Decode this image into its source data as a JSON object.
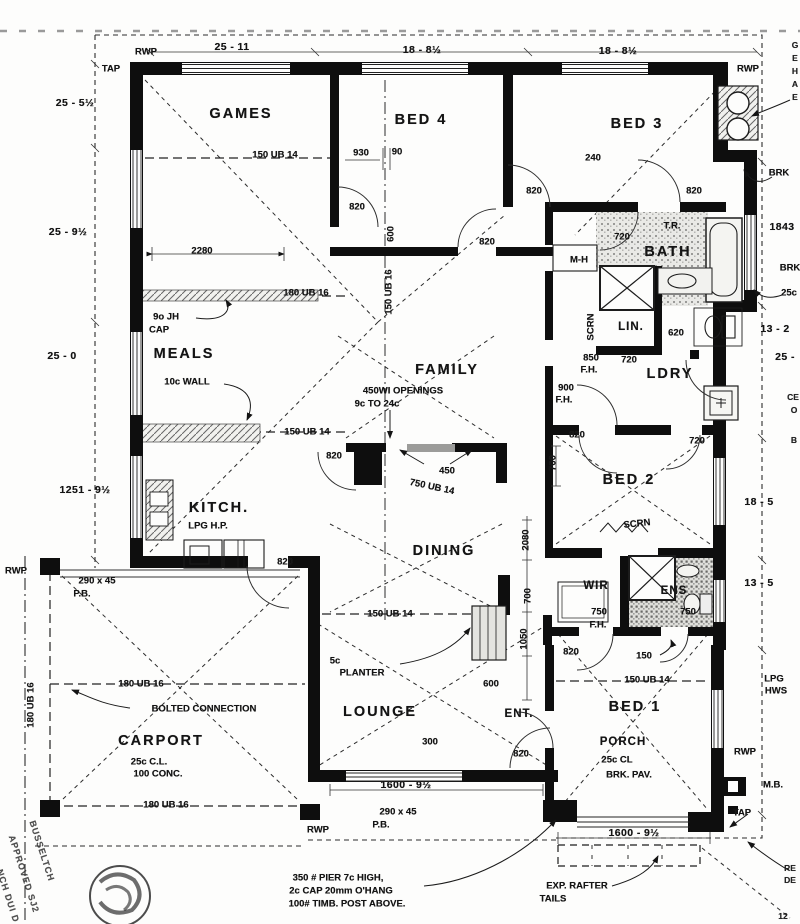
{
  "document": {
    "kind": "scanned residential floor plan working drawing"
  },
  "colors": {
    "ink": "#141414",
    "paper": "#fdfdfc",
    "tile_gray": "#9a9a98",
    "opening_gray": "#9c9c9a"
  },
  "labels": [
    {
      "t": "RWP",
      "x": 146,
      "y": 52,
      "c": "note",
      "n": "rwp-label"
    },
    {
      "t": "TAP",
      "x": 111,
      "y": 69,
      "c": "note",
      "n": "tap-label"
    },
    {
      "t": "25 - 11",
      "x": 232,
      "y": 47,
      "c": "dim",
      "n": "dimension-label"
    },
    {
      "t": "18 - 8½",
      "x": 422,
      "y": 50,
      "c": "dim",
      "n": "dimension-label"
    },
    {
      "t": "18 - 8½",
      "x": 618,
      "y": 51,
      "c": "dim",
      "n": "dimension-label"
    },
    {
      "t": "RWP",
      "x": 748,
      "y": 69,
      "c": "note",
      "n": "rwp-label"
    },
    {
      "t": "G",
      "x": 795,
      "y": 45,
      "c": "tiny",
      "n": "clipped-note"
    },
    {
      "t": "E",
      "x": 795,
      "y": 58,
      "c": "tiny",
      "n": "clipped-note"
    },
    {
      "t": "H",
      "x": 795,
      "y": 71,
      "c": "tiny",
      "n": "clipped-note"
    },
    {
      "t": "A",
      "x": 795,
      "y": 84,
      "c": "tiny",
      "n": "clipped-note"
    },
    {
      "t": "E",
      "x": 795,
      "y": 97,
      "c": "tiny",
      "n": "clipped-note"
    },
    {
      "t": "25 - 5½",
      "x": 75,
      "y": 103,
      "c": "dim",
      "n": "dimension-label"
    },
    {
      "t": "25 - 9½",
      "x": 68,
      "y": 232,
      "c": "dim",
      "n": "dimension-label"
    },
    {
      "t": "25 - 0",
      "x": 62,
      "y": 356,
      "c": "dim",
      "n": "dimension-label"
    },
    {
      "t": "1251 - 9½",
      "x": 85,
      "y": 490,
      "c": "dim",
      "n": "dimension-label"
    },
    {
      "t": "GAMES",
      "x": 241,
      "y": 114,
      "c": "room",
      "n": "room-label-games"
    },
    {
      "t": "BED 4",
      "x": 421,
      "y": 120,
      "c": "room",
      "n": "room-label-bed4"
    },
    {
      "t": "BED 3",
      "x": 637,
      "y": 124,
      "c": "room",
      "n": "room-label-bed3"
    },
    {
      "t": "150 UB 14",
      "x": 275,
      "y": 155,
      "c": "dim-s",
      "n": "beam-label"
    },
    {
      "t": "930",
      "x": 361,
      "y": 153,
      "c": "dim-s",
      "n": "dimension-label"
    },
    {
      "t": "90",
      "x": 397,
      "y": 152,
      "c": "dim-s",
      "n": "dimension-label"
    },
    {
      "t": "240",
      "x": 593,
      "y": 158,
      "c": "dim-s",
      "n": "dimension-label"
    },
    {
      "t": "820",
      "x": 357,
      "y": 207,
      "c": "dim-s",
      "n": "door-width-label"
    },
    {
      "t": "820",
      "x": 534,
      "y": 191,
      "c": "dim-s",
      "n": "door-width-label"
    },
    {
      "t": "820",
      "x": 694,
      "y": 191,
      "c": "dim-s",
      "n": "door-width-label"
    },
    {
      "t": "820",
      "x": 487,
      "y": 242,
      "c": "dim-s",
      "n": "door-width-label"
    },
    {
      "t": "BRK",
      "x": 779,
      "y": 173,
      "c": "note",
      "n": "brk-note"
    },
    {
      "t": "1843",
      "x": 782,
      "y": 227,
      "c": "dim",
      "n": "dimension-label"
    },
    {
      "t": "BRK",
      "x": 790,
      "y": 268,
      "c": "note",
      "n": "brk-note"
    },
    {
      "t": "25c",
      "x": 789,
      "y": 293,
      "c": "note",
      "n": "clipped-note"
    },
    {
      "t": "13 - 2",
      "x": 775,
      "y": 329,
      "c": "dim",
      "n": "dimension-label"
    },
    {
      "t": "25 -",
      "x": 785,
      "y": 357,
      "c": "dim",
      "n": "dimension-label"
    },
    {
      "t": "CE",
      "x": 793,
      "y": 397,
      "c": "tiny",
      "n": "clipped-note"
    },
    {
      "t": "O",
      "x": 794,
      "y": 410,
      "c": "tiny",
      "n": "clipped-note"
    },
    {
      "t": "B",
      "x": 794,
      "y": 440,
      "c": "tiny",
      "n": "clipped-note"
    },
    {
      "t": "T.R.",
      "x": 672,
      "y": 226,
      "c": "note",
      "n": "towel-rail-label"
    },
    {
      "t": "720",
      "x": 622,
      "y": 237,
      "c": "dim-s",
      "n": "door-width-label"
    },
    {
      "t": "BATH",
      "x": 668,
      "y": 252,
      "c": "room",
      "n": "room-label-bath"
    },
    {
      "t": "M-H",
      "x": 579,
      "y": 260,
      "c": "note",
      "n": "mh-label"
    },
    {
      "t": "2280",
      "x": 202,
      "y": 251,
      "c": "dim-s",
      "n": "dimension-label"
    },
    {
      "t": "180 UB 16",
      "x": 306,
      "y": 293,
      "c": "dim-s",
      "n": "beam-label"
    },
    {
      "t": "9o JH",
      "x": 166,
      "y": 317,
      "c": "note",
      "n": "cap-note"
    },
    {
      "t": "CAP",
      "x": 159,
      "y": 330,
      "c": "note",
      "n": "cap-note"
    },
    {
      "t": "SCRN",
      "x": 591,
      "y": 327,
      "c": "note",
      "r": -90,
      "n": "screen-label"
    },
    {
      "t": "LIN.",
      "x": 631,
      "y": 327,
      "c": "room-sm",
      "n": "room-label-linen"
    },
    {
      "t": "620",
      "x": 676,
      "y": 333,
      "c": "dim-s",
      "n": "door-width-label"
    },
    {
      "t": "MEALS",
      "x": 184,
      "y": 354,
      "c": "room",
      "n": "room-label-meals"
    },
    {
      "t": "850",
      "x": 591,
      "y": 358,
      "c": "dim-s",
      "n": "dimension-label"
    },
    {
      "t": "F.H.",
      "x": 589,
      "y": 370,
      "c": "dim-s",
      "n": "dimension-label"
    },
    {
      "t": "720",
      "x": 629,
      "y": 360,
      "c": "dim-s",
      "n": "door-width-label"
    },
    {
      "t": "LDRY",
      "x": 670,
      "y": 374,
      "c": "room",
      "n": "room-label-laundry"
    },
    {
      "t": "FAMILY",
      "x": 447,
      "y": 370,
      "c": "room",
      "n": "room-label-family"
    },
    {
      "t": "10c WALL",
      "x": 187,
      "y": 382,
      "c": "note",
      "n": "wall-note"
    },
    {
      "t": "450WI OPENINGS",
      "x": 403,
      "y": 391,
      "c": "note",
      "n": "openings-note"
    },
    {
      "t": "9c TO 24c",
      "x": 377,
      "y": 404,
      "c": "note",
      "n": "openings-note"
    },
    {
      "t": "900",
      "x": 566,
      "y": 388,
      "c": "dim-s",
      "n": "dimension-label"
    },
    {
      "t": "F.H.",
      "x": 564,
      "y": 400,
      "c": "dim-s",
      "n": "dimension-label"
    },
    {
      "t": "600",
      "x": 391,
      "y": 234,
      "c": "dim-s",
      "r": -90,
      "n": "dimension-label"
    },
    {
      "t": "150 UB 16",
      "x": 389,
      "y": 292,
      "c": "dim-s",
      "r": -90,
      "n": "beam-label"
    },
    {
      "t": "150 UB 14",
      "x": 307,
      "y": 432,
      "c": "dim-s",
      "n": "beam-label"
    },
    {
      "t": "820",
      "x": 334,
      "y": 456,
      "c": "dim-s",
      "n": "door-width-label"
    },
    {
      "t": "450",
      "x": 447,
      "y": 471,
      "c": "dim-s",
      "n": "dimension-label"
    },
    {
      "t": "750 UB 14",
      "x": 432,
      "y": 487,
      "c": "dim-s",
      "r": 12,
      "n": "beam-label"
    },
    {
      "t": "700",
      "x": 553,
      "y": 463,
      "c": "dim-s",
      "r": -90,
      "n": "dimension-label"
    },
    {
      "t": "820",
      "x": 577,
      "y": 435,
      "c": "dim-s",
      "n": "door-width-label"
    },
    {
      "t": "720",
      "x": 697,
      "y": 441,
      "c": "dim-s",
      "n": "door-width-label"
    },
    {
      "t": "BED 2",
      "x": 629,
      "y": 480,
      "c": "room",
      "n": "room-label-bed2"
    },
    {
      "t": "18 - 5",
      "x": 759,
      "y": 502,
      "c": "dim",
      "n": "dimension-label"
    },
    {
      "t": "13 - 5",
      "x": 759,
      "y": 583,
      "c": "dim",
      "n": "dimension-label"
    },
    {
      "t": "KITCH.",
      "x": 219,
      "y": 508,
      "c": "room",
      "n": "room-label-kitchen"
    },
    {
      "t": "LPG H.P.",
      "x": 208,
      "y": 526,
      "c": "note",
      "n": "lpg-note"
    },
    {
      "t": "RWP",
      "x": 16,
      "y": 571,
      "c": "note",
      "n": "rwp-label"
    },
    {
      "t": "290 x 45",
      "x": 97,
      "y": 581,
      "c": "note",
      "n": "beam-note"
    },
    {
      "t": "P.B.",
      "x": 82,
      "y": 594,
      "c": "note",
      "n": "beam-note"
    },
    {
      "t": "820",
      "x": 285,
      "y": 562,
      "c": "dim-s",
      "n": "door-width-label"
    },
    {
      "t": "SCRN",
      "x": 637,
      "y": 524,
      "c": "note",
      "r": -6,
      "n": "screen-label"
    },
    {
      "t": "DINING",
      "x": 444,
      "y": 551,
      "c": "room",
      "n": "room-label-dining"
    },
    {
      "t": "2080",
      "x": 526,
      "y": 540,
      "c": "dim-s",
      "r": -90,
      "n": "dimension-label"
    },
    {
      "t": "WIR",
      "x": 596,
      "y": 586,
      "c": "room-sm",
      "n": "room-label-wir"
    },
    {
      "t": "ENS",
      "x": 674,
      "y": 591,
      "c": "room-sm",
      "n": "room-label-ensuite"
    },
    {
      "t": "750",
      "x": 688,
      "y": 612,
      "c": "dim-s",
      "n": "dimension-label"
    },
    {
      "t": "750",
      "x": 599,
      "y": 612,
      "c": "dim-s",
      "n": "dimension-label"
    },
    {
      "t": "F.H.",
      "x": 598,
      "y": 625,
      "c": "dim-s",
      "n": "dimension-label"
    },
    {
      "t": "700",
      "x": 528,
      "y": 596,
      "c": "dim-s",
      "r": -90,
      "n": "dimension-label"
    },
    {
      "t": "150 UB 14",
      "x": 390,
      "y": 614,
      "c": "dim-s",
      "n": "beam-label"
    },
    {
      "t": "1050",
      "x": 524,
      "y": 639,
      "c": "dim-s",
      "r": -90,
      "n": "dimension-label"
    },
    {
      "t": "5c",
      "x": 335,
      "y": 661,
      "c": "note",
      "n": "planter-note"
    },
    {
      "t": "PLANTER",
      "x": 362,
      "y": 673,
      "c": "note",
      "n": "planter-note"
    },
    {
      "t": "600",
      "x": 491,
      "y": 684,
      "c": "dim-s",
      "n": "dimension-label"
    },
    {
      "t": "820",
      "x": 571,
      "y": 652,
      "c": "dim-s",
      "n": "door-width-label"
    },
    {
      "t": "150",
      "x": 644,
      "y": 656,
      "c": "dim-s",
      "n": "dimension-label"
    },
    {
      "t": "150 UB 14",
      "x": 647,
      "y": 680,
      "c": "dim-s",
      "n": "beam-label"
    },
    {
      "t": "180 UB 16",
      "x": 141,
      "y": 684,
      "c": "dim-s",
      "n": "beam-label"
    },
    {
      "t": "180 UB 16",
      "x": 31,
      "y": 705,
      "c": "dim-s",
      "r": -90,
      "n": "beam-label"
    },
    {
      "t": "BOLTED CONNECTION",
      "x": 204,
      "y": 709,
      "c": "note",
      "n": "bolted-connection-note"
    },
    {
      "t": "LOUNGE",
      "x": 380,
      "y": 712,
      "c": "room",
      "n": "room-label-lounge"
    },
    {
      "t": "ENT.",
      "x": 519,
      "y": 714,
      "c": "room-sm",
      "n": "room-label-entry"
    },
    {
      "t": "BED 1",
      "x": 635,
      "y": 707,
      "c": "room",
      "n": "room-label-bed1"
    },
    {
      "t": "LPG",
      "x": 774,
      "y": 679,
      "c": "note",
      "n": "lpg-hws-label"
    },
    {
      "t": "HWS",
      "x": 776,
      "y": 691,
      "c": "note",
      "n": "lpg-hws-label"
    },
    {
      "t": "CARPORT",
      "x": 161,
      "y": 741,
      "c": "room",
      "n": "room-label-carport"
    },
    {
      "t": "25c C.L.",
      "x": 149,
      "y": 762,
      "c": "note",
      "n": "carport-note"
    },
    {
      "t": "100 CONC.",
      "x": 158,
      "y": 774,
      "c": "note",
      "n": "carport-note"
    },
    {
      "t": "300",
      "x": 430,
      "y": 742,
      "c": "dim-s",
      "n": "dimension-label"
    },
    {
      "t": "820",
      "x": 521,
      "y": 754,
      "c": "dim-s",
      "n": "door-width-label"
    },
    {
      "t": "PORCH",
      "x": 623,
      "y": 742,
      "c": "room-sm",
      "n": "room-label-porch"
    },
    {
      "t": "25c CL",
      "x": 617,
      "y": 760,
      "c": "note",
      "n": "porch-note"
    },
    {
      "t": "BRK. PAV.",
      "x": 629,
      "y": 775,
      "c": "note",
      "n": "porch-note"
    },
    {
      "t": "RWP",
      "x": 745,
      "y": 752,
      "c": "note",
      "n": "rwp-label"
    },
    {
      "t": "M.B.",
      "x": 773,
      "y": 785,
      "c": "note",
      "n": "meter-box-label"
    },
    {
      "t": "1600 - 9½",
      "x": 406,
      "y": 785,
      "c": "dim",
      "n": "dimension-label"
    },
    {
      "t": "290 x 45",
      "x": 398,
      "y": 812,
      "c": "note",
      "n": "beam-note"
    },
    {
      "t": "P.B.",
      "x": 381,
      "y": 825,
      "c": "note",
      "n": "beam-note"
    },
    {
      "t": "180 UB 16",
      "x": 166,
      "y": 805,
      "c": "dim-s",
      "n": "beam-label"
    },
    {
      "t": "RWP",
      "x": 318,
      "y": 830,
      "c": "note",
      "n": "rwp-label"
    },
    {
      "t": "TAP",
      "x": 742,
      "y": 813,
      "c": "note",
      "n": "tap-label"
    },
    {
      "t": "1600 - 9½",
      "x": 634,
      "y": 833,
      "c": "dim",
      "n": "dimension-label"
    },
    {
      "t": "350 # PIER 7c HIGH,",
      "x": 338,
      "y": 878,
      "c": "note",
      "n": "pier-note"
    },
    {
      "t": "2c CAP 20mm O'HANG",
      "x": 341,
      "y": 891,
      "c": "note",
      "n": "pier-note"
    },
    {
      "t": "100# TIMB. POST ABOVE.",
      "x": 347,
      "y": 904,
      "c": "note",
      "n": "pier-note"
    },
    {
      "t": "EXP. RAFTER",
      "x": 577,
      "y": 886,
      "c": "note",
      "n": "rafter-note"
    },
    {
      "t": "TAILS",
      "x": 553,
      "y": 899,
      "c": "note",
      "n": "rafter-note"
    },
    {
      "t": "RE",
      "x": 790,
      "y": 868,
      "c": "tiny",
      "n": "clipped-note"
    },
    {
      "t": "DE",
      "x": 790,
      "y": 880,
      "c": "tiny",
      "n": "clipped-note"
    },
    {
      "t": "12",
      "x": 783,
      "y": 916,
      "c": "tiny",
      "n": "clipped-note"
    },
    {
      "t": "BUSSELTCH",
      "x": 42,
      "y": 851,
      "c": "stamp",
      "r": 72,
      "n": "approval-stamp-text"
    },
    {
      "t": "APPROVED SJ2",
      "x": 24,
      "y": 874,
      "c": "stamp",
      "r": 72,
      "n": "approval-stamp-text"
    },
    {
      "t": "NCH DUI D",
      "x": 8,
      "y": 896,
      "c": "stamp",
      "r": 72,
      "n": "approval-stamp-text"
    }
  ]
}
